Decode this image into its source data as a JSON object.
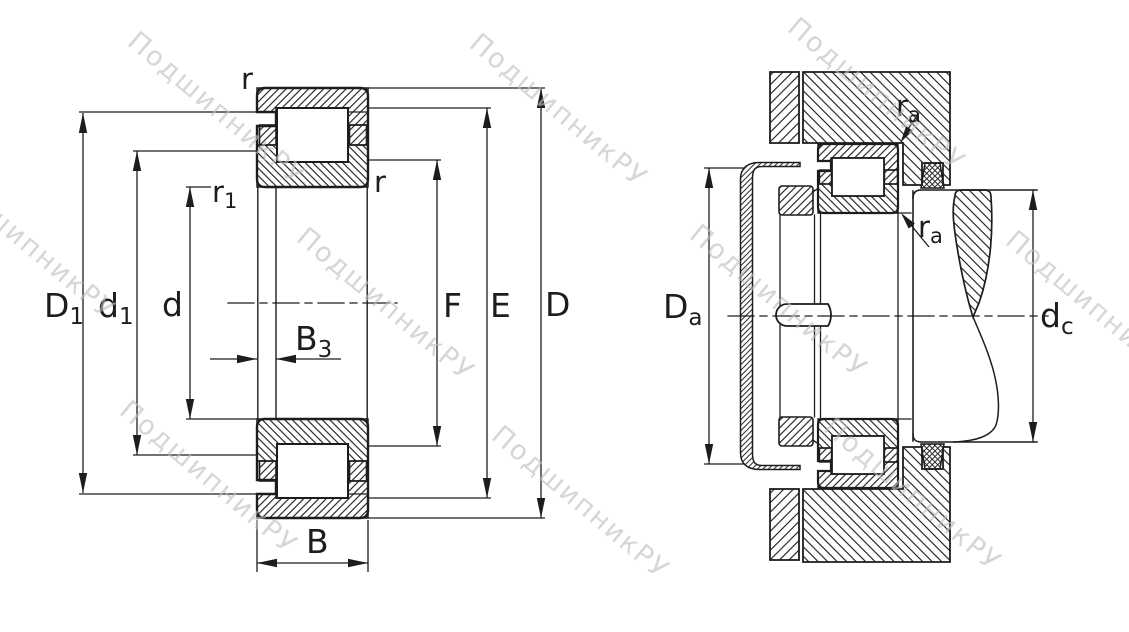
{
  "watermark": {
    "text": "ПодшипникРУ"
  },
  "colors": {
    "line": "#1d1d1d",
    "hatch": "#2e2e2e",
    "watermark": "#bdbdbd",
    "background": "#ffffff"
  },
  "views": {
    "left": {
      "name": "bearing-cross-section",
      "labels": {
        "r_top": "r",
        "r1_base": "r",
        "r1_sub": "1",
        "r_inner": "r",
        "D1_base": "D",
        "D1_sub": "1",
        "d1_base": "d",
        "d1_sub": "1",
        "d": "d",
        "B3_base": "B",
        "B3_sub": "3",
        "F": "F",
        "E": "E",
        "D": "D",
        "B": "B"
      }
    },
    "right": {
      "name": "mounted-bearing-arrangement",
      "labels": {
        "ra_top_base": "r",
        "ra_top_sub": "a",
        "ra_bot_base": "r",
        "ra_bot_sub": "a",
        "Da_base": "D",
        "Da_sub": "a",
        "dc_base": "d",
        "dc_sub": "c"
      }
    }
  }
}
